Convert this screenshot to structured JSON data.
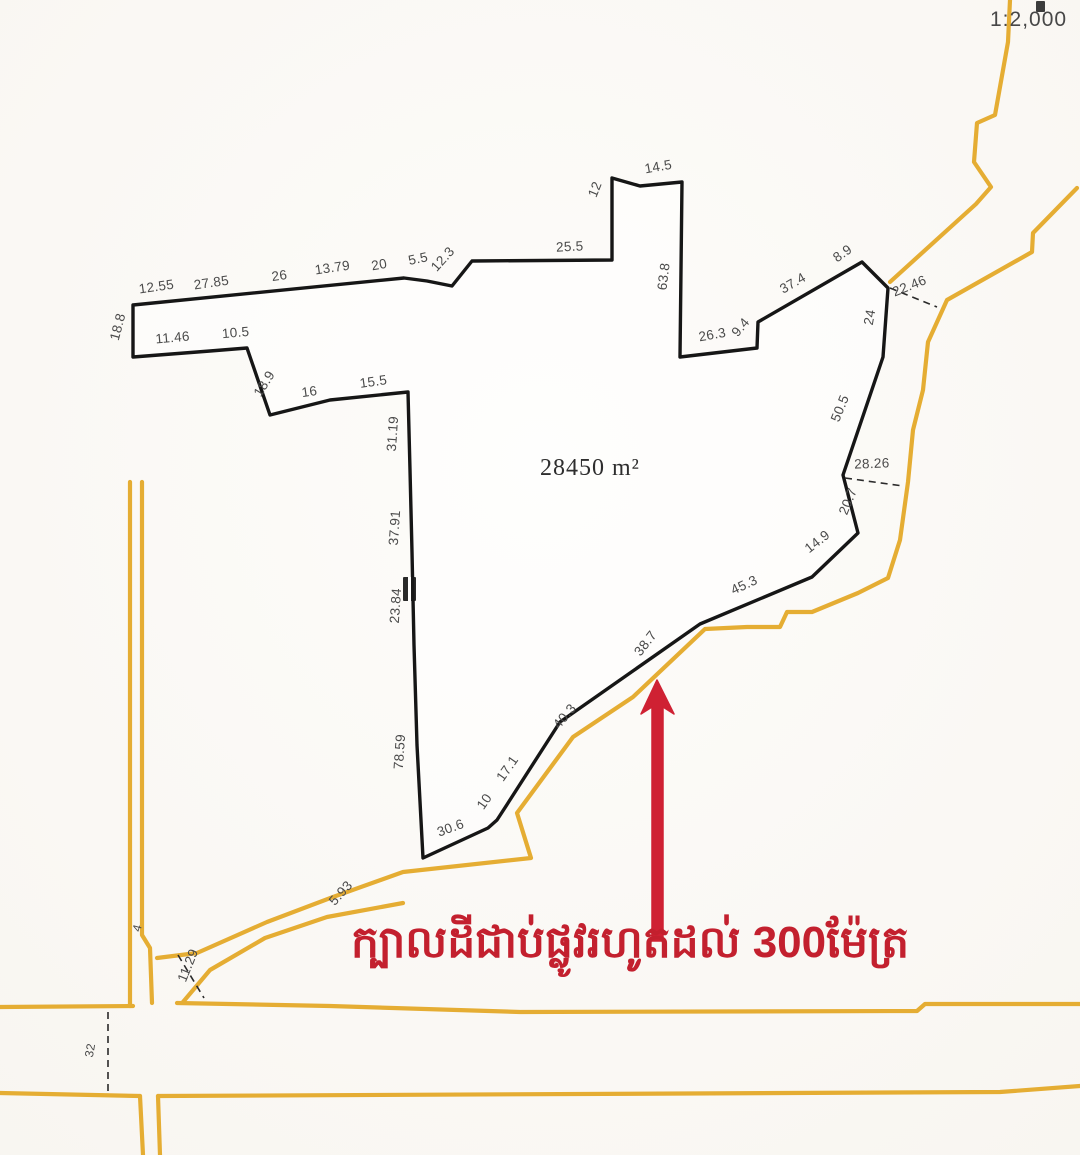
{
  "map": {
    "scale_label": "1:2,000",
    "colors": {
      "boundary": "#161616",
      "road": "#e5ad33",
      "label": "#4a4a4a",
      "arrow": "#cf2133",
      "annotation_text": "#c3202e"
    },
    "parcel": {
      "area_label": "28450 m²",
      "boundary_points": [
        [
          133,
          305
        ],
        [
          404,
          278
        ],
        [
          427,
          281
        ],
        [
          452,
          286
        ],
        [
          472,
          261
        ],
        [
          612,
          260
        ],
        [
          612,
          178
        ],
        [
          640,
          186
        ],
        [
          682,
          182
        ],
        [
          680,
          357
        ],
        [
          757,
          348
        ],
        [
          758,
          322
        ],
        [
          862,
          262
        ],
        [
          888,
          288
        ],
        [
          883,
          357
        ],
        [
          843,
          475
        ],
        [
          858,
          533
        ],
        [
          812,
          577
        ],
        [
          700,
          624
        ],
        [
          560,
          722
        ],
        [
          508,
          803
        ],
        [
          497,
          820
        ],
        [
          488,
          828
        ],
        [
          423,
          858
        ],
        [
          417,
          745
        ],
        [
          414,
          645
        ],
        [
          412,
          552
        ],
        [
          410,
          470
        ],
        [
          408,
          392
        ],
        [
          330,
          400
        ],
        [
          270,
          415
        ],
        [
          247,
          348
        ],
        [
          210,
          351
        ],
        [
          133,
          357
        ]
      ]
    },
    "roads": [
      {
        "points": [
          [
            1010,
            0
          ],
          [
            1008,
            42
          ],
          [
            995,
            115
          ],
          [
            977,
            123
          ],
          [
            974,
            162
          ],
          [
            991,
            187
          ],
          [
            976,
            204
          ],
          [
            890,
            282
          ]
        ]
      },
      {
        "points": [
          [
            1077,
            188
          ],
          [
            1033,
            233
          ],
          [
            1032,
            252
          ],
          [
            947,
            300
          ],
          [
            928,
            342
          ],
          [
            923,
            390
          ],
          [
            913,
            430
          ],
          [
            908,
            482
          ],
          [
            900,
            540
          ],
          [
            888,
            578
          ],
          [
            858,
            593
          ],
          [
            812,
            612
          ],
          [
            787,
            612
          ],
          [
            780,
            627
          ],
          [
            747,
            627
          ],
          [
            705,
            629
          ],
          [
            633,
            697
          ],
          [
            573,
            737
          ],
          [
            517,
            813
          ],
          [
            531,
            858
          ],
          [
            403,
            872
          ],
          [
            333,
            897
          ],
          [
            267,
            922
          ],
          [
            197,
            953
          ],
          [
            157,
            958
          ]
        ]
      },
      {
        "points": [
          [
            403,
            903
          ],
          [
            327,
            917
          ],
          [
            265,
            938
          ],
          [
            210,
            970
          ],
          [
            183,
            1002
          ]
        ]
      },
      {
        "points": [
          [
            130,
            482
          ],
          [
            130,
            1006
          ]
        ]
      },
      {
        "points": [
          [
            142,
            482
          ],
          [
            142,
            935
          ],
          [
            150,
            948
          ],
          [
            152,
            1003
          ]
        ]
      },
      {
        "points": [
          [
            0,
            1007
          ],
          [
            133,
            1006
          ]
        ]
      },
      {
        "points": [
          [
            177,
            1003
          ],
          [
            330,
            1006
          ],
          [
            520,
            1012
          ],
          [
            917,
            1011
          ],
          [
            925,
            1004
          ],
          [
            1080,
            1004
          ]
        ]
      },
      {
        "points": [
          [
            0,
            1093
          ],
          [
            140,
            1096
          ]
        ]
      },
      {
        "points": [
          [
            158,
            1096
          ],
          [
            1000,
            1092
          ],
          [
            1080,
            1086
          ]
        ]
      },
      {
        "points": [
          [
            140,
            1096
          ],
          [
            143,
            1155
          ]
        ]
      },
      {
        "points": [
          [
            158,
            1096
          ],
          [
            160,
            1155
          ]
        ]
      }
    ],
    "dashed_lines": [
      {
        "x1": 890,
        "y1": 288,
        "x2": 937,
        "y2": 307
      },
      {
        "x1": 845,
        "y1": 478,
        "x2": 903,
        "y2": 486
      },
      {
        "x1": 108,
        "y1": 1012,
        "x2": 108,
        "y2": 1092
      },
      {
        "x1": 178,
        "y1": 955,
        "x2": 204,
        "y2": 998
      }
    ],
    "measurements": [
      {
        "text": "12.55",
        "x": 157,
        "y": 291,
        "rot": -8
      },
      {
        "text": "27.85",
        "x": 212,
        "y": 287,
        "rot": -8
      },
      {
        "text": "26",
        "x": 280,
        "y": 280,
        "rot": -8
      },
      {
        "text": "13.79",
        "x": 333,
        "y": 272,
        "rot": -8
      },
      {
        "text": "20",
        "x": 380,
        "y": 269,
        "rot": -10
      },
      {
        "text": "5.5",
        "x": 419,
        "y": 263,
        "rot": -12
      },
      {
        "text": "12.3",
        "x": 446,
        "y": 262,
        "rot": -48
      },
      {
        "text": "25.5",
        "x": 570,
        "y": 251,
        "rot": -3
      },
      {
        "text": "12",
        "x": 599,
        "y": 191,
        "rot": -68
      },
      {
        "text": "14.5",
        "x": 659,
        "y": 171,
        "rot": -10
      },
      {
        "text": "63.8",
        "x": 668,
        "y": 277,
        "rot": -83
      },
      {
        "text": "26.3",
        "x": 713,
        "y": 339,
        "rot": -10
      },
      {
        "text": "9.4",
        "x": 744,
        "y": 330,
        "rot": -50
      },
      {
        "text": "37.4",
        "x": 795,
        "y": 287,
        "rot": -30
      },
      {
        "text": "8.9",
        "x": 845,
        "y": 257,
        "rot": -35
      },
      {
        "text": "22.46",
        "x": 911,
        "y": 290,
        "rot": -22
      },
      {
        "text": "24",
        "x": 874,
        "y": 318,
        "rot": -80
      },
      {
        "text": "50.5",
        "x": 844,
        "y": 410,
        "rot": -68
      },
      {
        "text": "28.26",
        "x": 872,
        "y": 468,
        "rot": -2
      },
      {
        "text": "20.7",
        "x": 852,
        "y": 503,
        "rot": -68
      },
      {
        "text": "14.9",
        "x": 820,
        "y": 545,
        "rot": -38
      },
      {
        "text": "45.3",
        "x": 746,
        "y": 589,
        "rot": -25
      },
      {
        "text": "38.7",
        "x": 649,
        "y": 646,
        "rot": -52
      },
      {
        "text": "40.3",
        "x": 568,
        "y": 719,
        "rot": -50
      },
      {
        "text": "17.1",
        "x": 511,
        "y": 771,
        "rot": -55
      },
      {
        "text": "10",
        "x": 488,
        "y": 804,
        "rot": -55
      },
      {
        "text": "30.6",
        "x": 452,
        "y": 832,
        "rot": -20
      },
      {
        "text": "78.59",
        "x": 404,
        "y": 752,
        "rot": -86
      },
      {
        "text": "23.84",
        "x": 400,
        "y": 606,
        "rot": -86
      },
      {
        "text": "37.91",
        "x": 399,
        "y": 528,
        "rot": -86
      },
      {
        "text": "31.19",
        "x": 397,
        "y": 434,
        "rot": -86
      },
      {
        "text": "15.5",
        "x": 374,
        "y": 386,
        "rot": -8
      },
      {
        "text": "16",
        "x": 310,
        "y": 396,
        "rot": -8
      },
      {
        "text": "18.9",
        "x": 268,
        "y": 386,
        "rot": -58
      },
      {
        "text": "10.5",
        "x": 236,
        "y": 337,
        "rot": -5
      },
      {
        "text": "11.46",
        "x": 173,
        "y": 342,
        "rot": -5
      },
      {
        "text": "18.8",
        "x": 122,
        "y": 328,
        "rot": -75
      },
      {
        "text": "5.93",
        "x": 344,
        "y": 896,
        "rot": -48
      },
      {
        "text": "11.29",
        "x": 192,
        "y": 967,
        "rot": -68
      },
      {
        "text": "4",
        "x": 141,
        "y": 929,
        "rot": -75,
        "size": 12
      },
      {
        "text": "32",
        "x": 94,
        "y": 1051,
        "rot": -80,
        "size": 12
      }
    ],
    "arrow": {
      "points": [
        [
          657,
          680
        ],
        [
          674,
          714
        ],
        [
          663,
          707
        ],
        [
          663,
          941
        ],
        [
          652,
          941
        ],
        [
          652,
          707
        ],
        [
          641,
          714
        ]
      ]
    },
    "annotation": {
      "text": "ក្បាលដីជាប់ផ្លូវរហូតដល់ 300ម៉ែត្រ"
    }
  }
}
